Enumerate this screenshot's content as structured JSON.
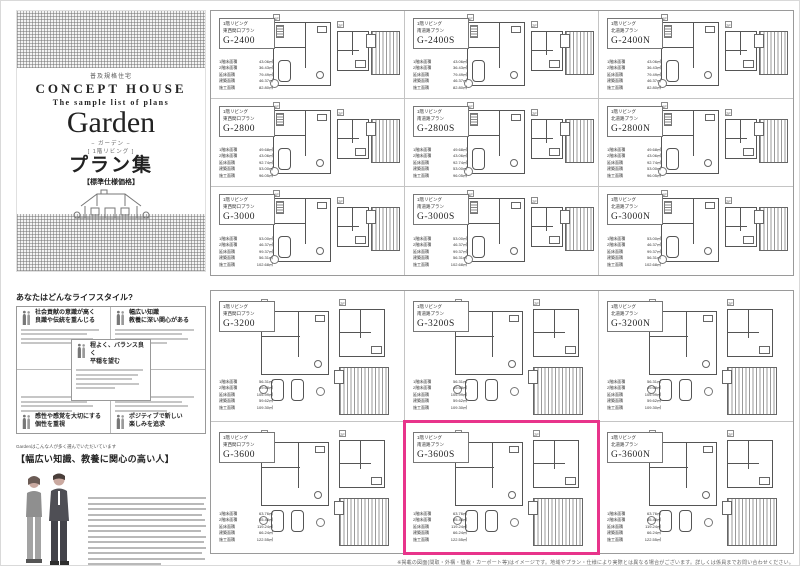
{
  "cover": {
    "tagline": "普及規格住宅",
    "brand": "CONCEPT HOUSE",
    "subtitle": "The sample list of plans",
    "series_name": "Garden",
    "series_kana": "− ガーデン −",
    "series_note": "[ 1階リビング ]",
    "title_jp": "プラン集",
    "spec_note": "【標準仕様価格】"
  },
  "lifestyle": {
    "title": "あなたはどんなライフスタイル?",
    "quadrants": [
      {
        "line1": "社会貢献の意識が高く",
        "line2": "良識や伝統を重んじる"
      },
      {
        "line1": "幅広い知識",
        "line2": "教養に深い関心がある"
      },
      {
        "line1": "感性や感覚を大切にする",
        "line2": "個性を重視"
      },
      {
        "line1": "ポジティブで新しい",
        "line2": "楽しみを追求"
      }
    ],
    "center": {
      "line1": "程よく、バランス良く",
      "line2": "平穏を望む"
    }
  },
  "recommend": {
    "lead": "Gardenはこんな人が多く選んでいただいています",
    "headline": "【幅広い知識、教養に関心の高い人】"
  },
  "plan_catalog": {
    "floor_label": "1階リビング",
    "column_types": [
      "東西間口プラン",
      "南道路プラン",
      "北道路プラン"
    ],
    "floor_markers": [
      "1F",
      "2F"
    ],
    "spec_labels": [
      "1階床面積",
      "2階床面積",
      "延床面積",
      "建築面積",
      "施工面積"
    ],
    "panels": [
      {
        "id": "top",
        "rows": [
          {
            "codes": [
              "G-2400",
              "G-2400S",
              "G-2400N"
            ],
            "specs": [
              "43.06㎡",
              "36.43㎡",
              "79.49㎡",
              "46.37㎡",
              "82.80㎡"
            ]
          },
          {
            "codes": [
              "G-2800",
              "G-2800S",
              "G-2800N"
            ],
            "specs": [
              "49.68㎡",
              "43.06㎡",
              "92.74㎡",
              "53.00㎡",
              "96.05㎡"
            ]
          },
          {
            "codes": [
              "G-3000",
              "G-3000S",
              "G-3000N"
            ],
            "specs": [
              "53.00㎡",
              "46.37㎡",
              "99.37㎡",
              "56.31㎡",
              "102.68㎡"
            ]
          }
        ]
      },
      {
        "id": "bottom",
        "rows": [
          {
            "codes": [
              "G-3200",
              "G-3200S",
              "G-3200N"
            ],
            "specs": [
              "56.31㎡",
              "49.68㎡",
              "105.99㎡",
              "59.62㎡",
              "109.30㎡"
            ]
          },
          {
            "codes": [
              "G-3600",
              "G-3600S",
              "G-3600N"
            ],
            "specs": [
              "63.76㎡",
              "55.48㎡",
              "119.24㎡",
              "66.24㎡",
              "122.55㎡"
            ]
          }
        ]
      }
    ],
    "highlight": {
      "code": "G-3600S",
      "color": "#e8348b"
    }
  },
  "footer": {
    "disclaimer": "※掲載の図面(間取・外構・植栽・カーポート等)はイメージです。地域やプラン・仕様により実際とは異なる場合がございます。詳しくは係員までお問い合わせください。"
  }
}
